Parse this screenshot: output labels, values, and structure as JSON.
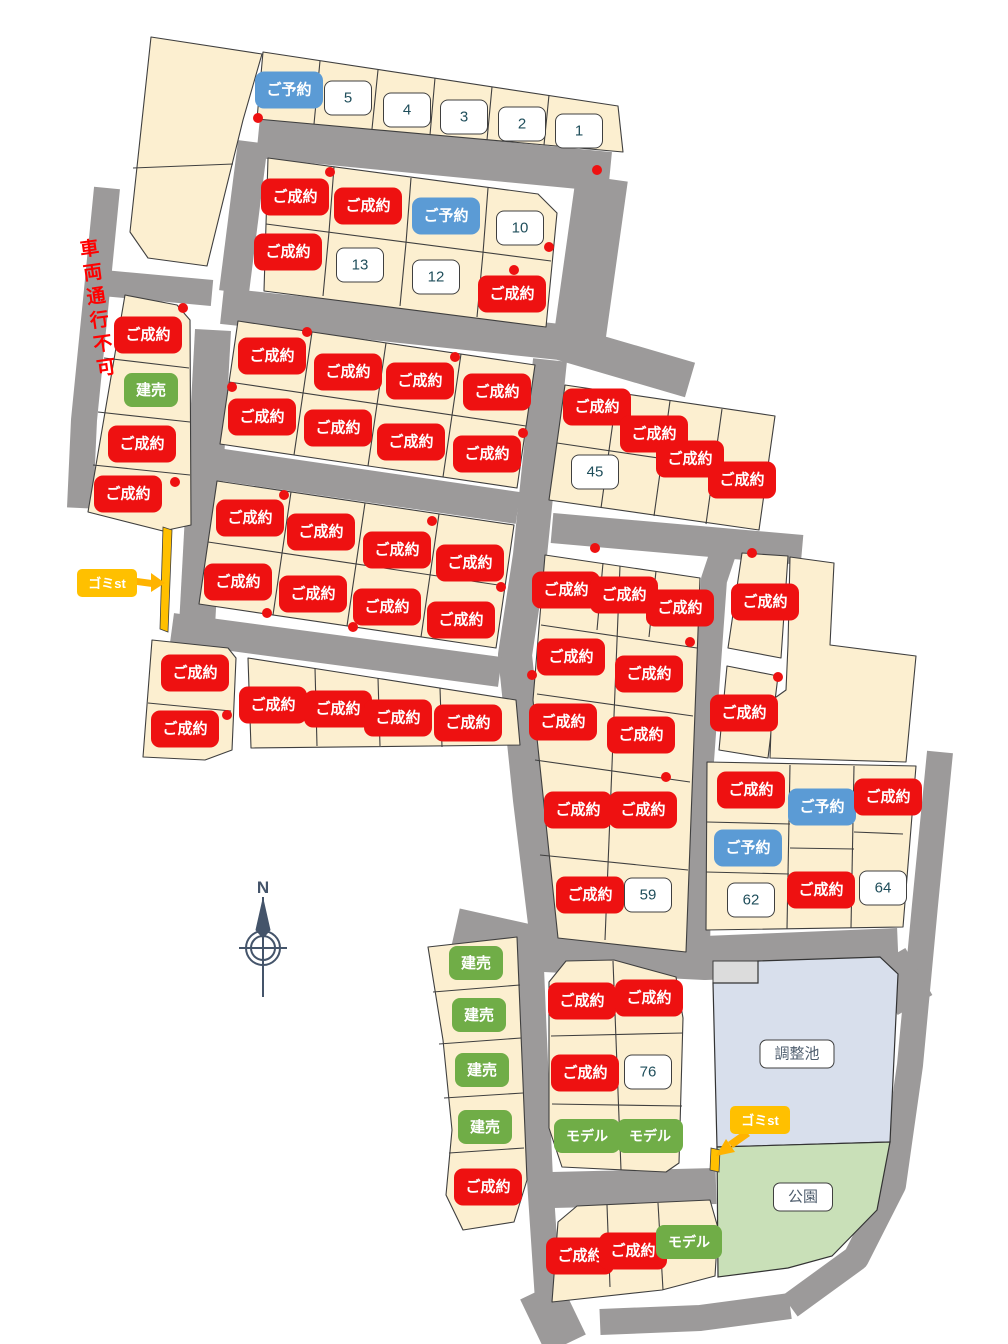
{
  "map_title": "分譲地区画図",
  "colors": {
    "sold": "#EE1111",
    "reserved": "#5B9BD5",
    "green": "#70AD47",
    "garbage": "#FFC000",
    "road": "#9C9A9A",
    "lot_fill": "#FCEFD0",
    "pond_fill": "#D8DFEC",
    "park_fill": "#C9E0B8",
    "number_text": "#1F4E5B",
    "note_red": "#FF0000",
    "compass": "#44546A"
  },
  "badges": [
    {
      "label": "ご予約",
      "type": "reserved",
      "x": 289,
      "y": 90
    },
    {
      "label": "5",
      "type": "num",
      "x": 348,
      "y": 98
    },
    {
      "label": "4",
      "type": "num",
      "x": 407,
      "y": 110
    },
    {
      "label": "3",
      "type": "num",
      "x": 464,
      "y": 117
    },
    {
      "label": "2",
      "type": "num",
      "x": 522,
      "y": 124
    },
    {
      "label": "1",
      "type": "num",
      "x": 579,
      "y": 131
    },
    {
      "label": "ご成約",
      "type": "sold",
      "x": 295,
      "y": 197
    },
    {
      "label": "ご成約",
      "type": "sold",
      "x": 368,
      "y": 206
    },
    {
      "label": "ご予約",
      "type": "reserved",
      "x": 446,
      "y": 216
    },
    {
      "label": "10",
      "type": "num",
      "x": 520,
      "y": 228
    },
    {
      "label": "ご成約",
      "type": "sold",
      "x": 288,
      "y": 252
    },
    {
      "label": "13",
      "type": "num",
      "x": 360,
      "y": 265
    },
    {
      "label": "12",
      "type": "num",
      "x": 436,
      "y": 277
    },
    {
      "label": "ご成約",
      "type": "sold",
      "x": 512,
      "y": 294
    },
    {
      "label": "ご成約",
      "type": "sold",
      "x": 148,
      "y": 335
    },
    {
      "label": "建売",
      "type": "built",
      "x": 151,
      "y": 390
    },
    {
      "label": "ご成約",
      "type": "sold",
      "x": 142,
      "y": 444
    },
    {
      "label": "ご成約",
      "type": "sold",
      "x": 128,
      "y": 494
    },
    {
      "label": "ご成約",
      "type": "sold",
      "x": 272,
      "y": 356
    },
    {
      "label": "ご成約",
      "type": "sold",
      "x": 348,
      "y": 372
    },
    {
      "label": "ご成約",
      "type": "sold",
      "x": 420,
      "y": 381
    },
    {
      "label": "ご成約",
      "type": "sold",
      "x": 497,
      "y": 392
    },
    {
      "label": "ご成約",
      "type": "sold",
      "x": 262,
      "y": 417
    },
    {
      "label": "ご成約",
      "type": "sold",
      "x": 338,
      "y": 428
    },
    {
      "label": "ご成約",
      "type": "sold",
      "x": 411,
      "y": 442
    },
    {
      "label": "ご成約",
      "type": "sold",
      "x": 487,
      "y": 454
    },
    {
      "label": "ご成約",
      "type": "sold",
      "x": 250,
      "y": 518
    },
    {
      "label": "ご成約",
      "type": "sold",
      "x": 321,
      "y": 532
    },
    {
      "label": "ご成約",
      "type": "sold",
      "x": 397,
      "y": 550
    },
    {
      "label": "ご成約",
      "type": "sold",
      "x": 470,
      "y": 563
    },
    {
      "label": "ご成約",
      "type": "sold",
      "x": 238,
      "y": 582
    },
    {
      "label": "ご成約",
      "type": "sold",
      "x": 313,
      "y": 594
    },
    {
      "label": "ご成約",
      "type": "sold",
      "x": 387,
      "y": 607
    },
    {
      "label": "ご成約",
      "type": "sold",
      "x": 461,
      "y": 620
    },
    {
      "label": "ご成約",
      "type": "sold",
      "x": 597,
      "y": 407
    },
    {
      "label": "ご成約",
      "type": "sold",
      "x": 654,
      "y": 434
    },
    {
      "label": "ご成約",
      "type": "sold",
      "x": 690,
      "y": 459
    },
    {
      "label": "ご成約",
      "type": "sold",
      "x": 742,
      "y": 480
    },
    {
      "label": "45",
      "type": "num",
      "x": 595,
      "y": 472
    },
    {
      "label": "ご成約",
      "type": "sold",
      "x": 566,
      "y": 590
    },
    {
      "label": "ご成約",
      "type": "sold",
      "x": 624,
      "y": 595
    },
    {
      "label": "ご成約",
      "type": "sold",
      "x": 680,
      "y": 608
    },
    {
      "label": "ご成約",
      "type": "sold",
      "x": 571,
      "y": 657
    },
    {
      "label": "ご成約",
      "type": "sold",
      "x": 649,
      "y": 674
    },
    {
      "label": "ご成約",
      "type": "sold",
      "x": 563,
      "y": 722
    },
    {
      "label": "ご成約",
      "type": "sold",
      "x": 641,
      "y": 735
    },
    {
      "label": "ご成約",
      "type": "sold",
      "x": 578,
      "y": 810
    },
    {
      "label": "ご成約",
      "type": "sold",
      "x": 643,
      "y": 810
    },
    {
      "label": "ご成約",
      "type": "sold",
      "x": 590,
      "y": 895
    },
    {
      "label": "59",
      "type": "num",
      "x": 648,
      "y": 895
    },
    {
      "label": "ご成約",
      "type": "sold",
      "x": 765,
      "y": 602
    },
    {
      "label": "ご成約",
      "type": "sold",
      "x": 744,
      "y": 713
    },
    {
      "label": "ご成約",
      "type": "sold",
      "x": 751,
      "y": 790
    },
    {
      "label": "ご予約",
      "type": "reserved",
      "x": 822,
      "y": 807
    },
    {
      "label": "ご成約",
      "type": "sold",
      "x": 888,
      "y": 797
    },
    {
      "label": "ご予約",
      "type": "reserved",
      "x": 748,
      "y": 848
    },
    {
      "label": "62",
      "type": "num",
      "x": 751,
      "y": 900
    },
    {
      "label": "ご成約",
      "type": "sold",
      "x": 821,
      "y": 890
    },
    {
      "label": "64",
      "type": "num",
      "x": 883,
      "y": 888
    },
    {
      "label": "ご成約",
      "type": "sold",
      "x": 195,
      "y": 673
    },
    {
      "label": "ご成約",
      "type": "sold",
      "x": 185,
      "y": 729
    },
    {
      "label": "ご成約",
      "type": "sold",
      "x": 273,
      "y": 705
    },
    {
      "label": "ご成約",
      "type": "sold",
      "x": 338,
      "y": 709
    },
    {
      "label": "ご成約",
      "type": "sold",
      "x": 398,
      "y": 718
    },
    {
      "label": "ご成約",
      "type": "sold",
      "x": 468,
      "y": 723
    },
    {
      "label": "建売",
      "type": "built",
      "x": 476,
      "y": 963
    },
    {
      "label": "建売",
      "type": "built",
      "x": 479,
      "y": 1015
    },
    {
      "label": "建売",
      "type": "built",
      "x": 482,
      "y": 1070
    },
    {
      "label": "建売",
      "type": "built",
      "x": 485,
      "y": 1127
    },
    {
      "label": "ご成約",
      "type": "sold",
      "x": 488,
      "y": 1187
    },
    {
      "label": "ご成約",
      "type": "sold",
      "x": 582,
      "y": 1001
    },
    {
      "label": "ご成約",
      "type": "sold",
      "x": 649,
      "y": 998
    },
    {
      "label": "ご成約",
      "type": "sold",
      "x": 585,
      "y": 1073
    },
    {
      "label": "76",
      "type": "num",
      "x": 648,
      "y": 1072
    },
    {
      "label": "モデル",
      "type": "model",
      "x": 587,
      "y": 1136
    },
    {
      "label": "モデル",
      "type": "model",
      "x": 650,
      "y": 1136
    },
    {
      "label": "ご成約",
      "type": "sold",
      "x": 580,
      "y": 1256
    },
    {
      "label": "ご成約",
      "type": "sold",
      "x": 633,
      "y": 1251
    },
    {
      "label": "モデル",
      "type": "model",
      "x": 689,
      "y": 1242
    }
  ],
  "area_labels": [
    {
      "label": "調整池",
      "x": 797,
      "y": 1054
    },
    {
      "label": "公園",
      "x": 803,
      "y": 1197
    }
  ],
  "garbage_stations": [
    {
      "label": "ゴミst",
      "x": 107,
      "y": 583,
      "arrow": "right"
    },
    {
      "label": "ゴミst",
      "x": 760,
      "y": 1120,
      "arrow": "down-left"
    }
  ],
  "no_vehicle_note": {
    "text": "車両通行不可",
    "x": 96,
    "y": 310
  },
  "compass": {
    "label": "N",
    "x": 263,
    "y": 940
  },
  "dots": [
    [
      258,
      118
    ],
    [
      597,
      170
    ],
    [
      330,
      172
    ],
    [
      549,
      247
    ],
    [
      514,
      270
    ],
    [
      183,
      308
    ],
    [
      307,
      332
    ],
    [
      455,
      357
    ],
    [
      232,
      387
    ],
    [
      523,
      433
    ],
    [
      175,
      482
    ],
    [
      284,
      495
    ],
    [
      432,
      521
    ],
    [
      501,
      587
    ],
    [
      267,
      613
    ],
    [
      353,
      627
    ],
    [
      595,
      548
    ],
    [
      752,
      553
    ],
    [
      690,
      642
    ],
    [
      532,
      675
    ],
    [
      778,
      677
    ],
    [
      666,
      777
    ],
    [
      227,
      715
    ]
  ]
}
